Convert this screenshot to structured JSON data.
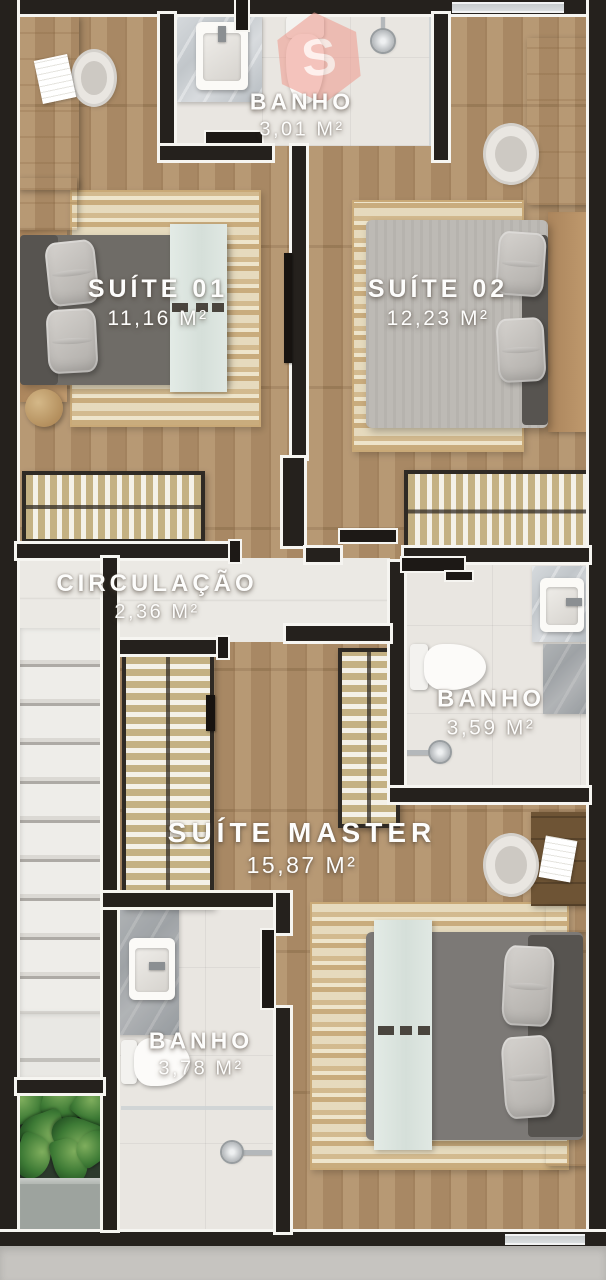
{
  "plan_title": "Floor plan - pavimento superior",
  "rooms": [
    {
      "id": "banho-superior",
      "name": "BANHO",
      "area": "3,01 M²"
    },
    {
      "id": "suite-01",
      "name": "SUÍTE 01",
      "area": "11,16 M²"
    },
    {
      "id": "suite-02",
      "name": "SUÍTE 02",
      "area": "12,23 M²"
    },
    {
      "id": "circulacao",
      "name": "CIRCULAÇÃO",
      "area": "2,36 M²"
    },
    {
      "id": "banho-meio",
      "name": "BANHO",
      "area": "3,59 M²"
    },
    {
      "id": "suite-master",
      "name": "SUÍTE MASTER",
      "area": "15,87 M²"
    },
    {
      "id": "banho-inferior",
      "name": "BANHO",
      "area": "3,78 M²"
    }
  ],
  "watermark": {
    "letter": "S",
    "color": "#ee9f93"
  },
  "palette": {
    "wall": "#25211d",
    "wall_trim": "#f6f5f1",
    "wood_floor": "#b2916a",
    "tile_floor": "#e9e6e1",
    "rug": "#ddcfae",
    "bed_gray": "#7c7976",
    "mint_runner": "#dce6e0",
    "wardrobe": "#c4b183",
    "plant_green": "#3d7a35",
    "marble": "#c8cdd1"
  }
}
